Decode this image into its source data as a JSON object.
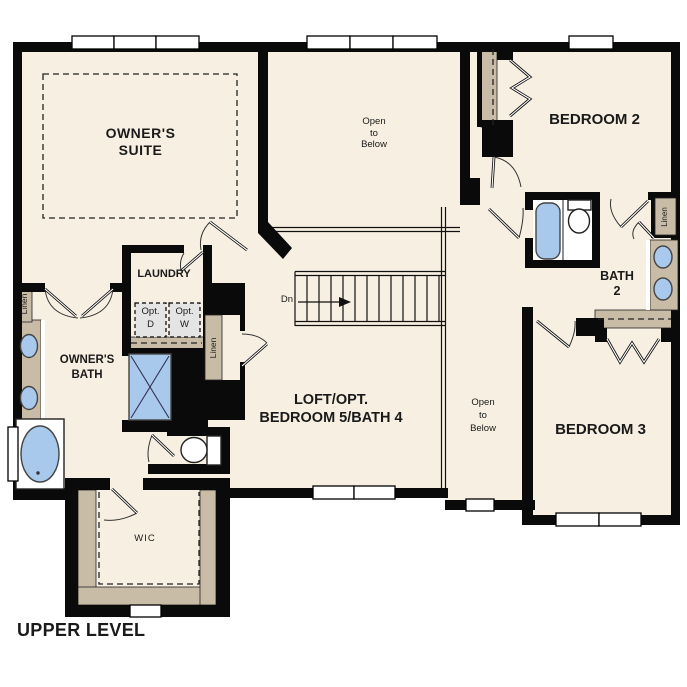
{
  "title": "UPPER LEVEL",
  "colors": {
    "floor": "#F7EFE1",
    "wall": "#0A0A0A",
    "tan": "#C9BCA6",
    "fixture_blue": "#A8C9EC",
    "appliance_gray": "#E4E4E4",
    "ink": "#1A1A1A",
    "paper": "#FFFFFF"
  },
  "rooms": {
    "owners_suite": {
      "lines": [
        "OWNER'S",
        "SUITE"
      ]
    },
    "open_to_below_upper": {
      "lines": [
        "Open",
        "to",
        "Below"
      ]
    },
    "bedroom_2": {
      "name": "BEDROOM 2"
    },
    "bath_2": {
      "lines": [
        "BATH",
        "2"
      ]
    },
    "bedroom_3": {
      "name": "BEDROOM 3"
    },
    "loft": {
      "lines": [
        "LOFT/OPT.",
        "BEDROOM 5/BATH 4"
      ]
    },
    "open_to_below_lower": {
      "lines": [
        "Open",
        "to",
        "Below"
      ]
    },
    "laundry": {
      "name": "LAUNDRY"
    },
    "owners_bath": {
      "lines": [
        "OWNER'S",
        "BATH"
      ]
    },
    "wic": {
      "name": "WIC"
    }
  },
  "labels": {
    "linen": "Linen",
    "stairs_down": "Dn",
    "opt_dryer": [
      "Opt.",
      "D"
    ],
    "opt_washer": [
      "Opt.",
      "W"
    ]
  }
}
